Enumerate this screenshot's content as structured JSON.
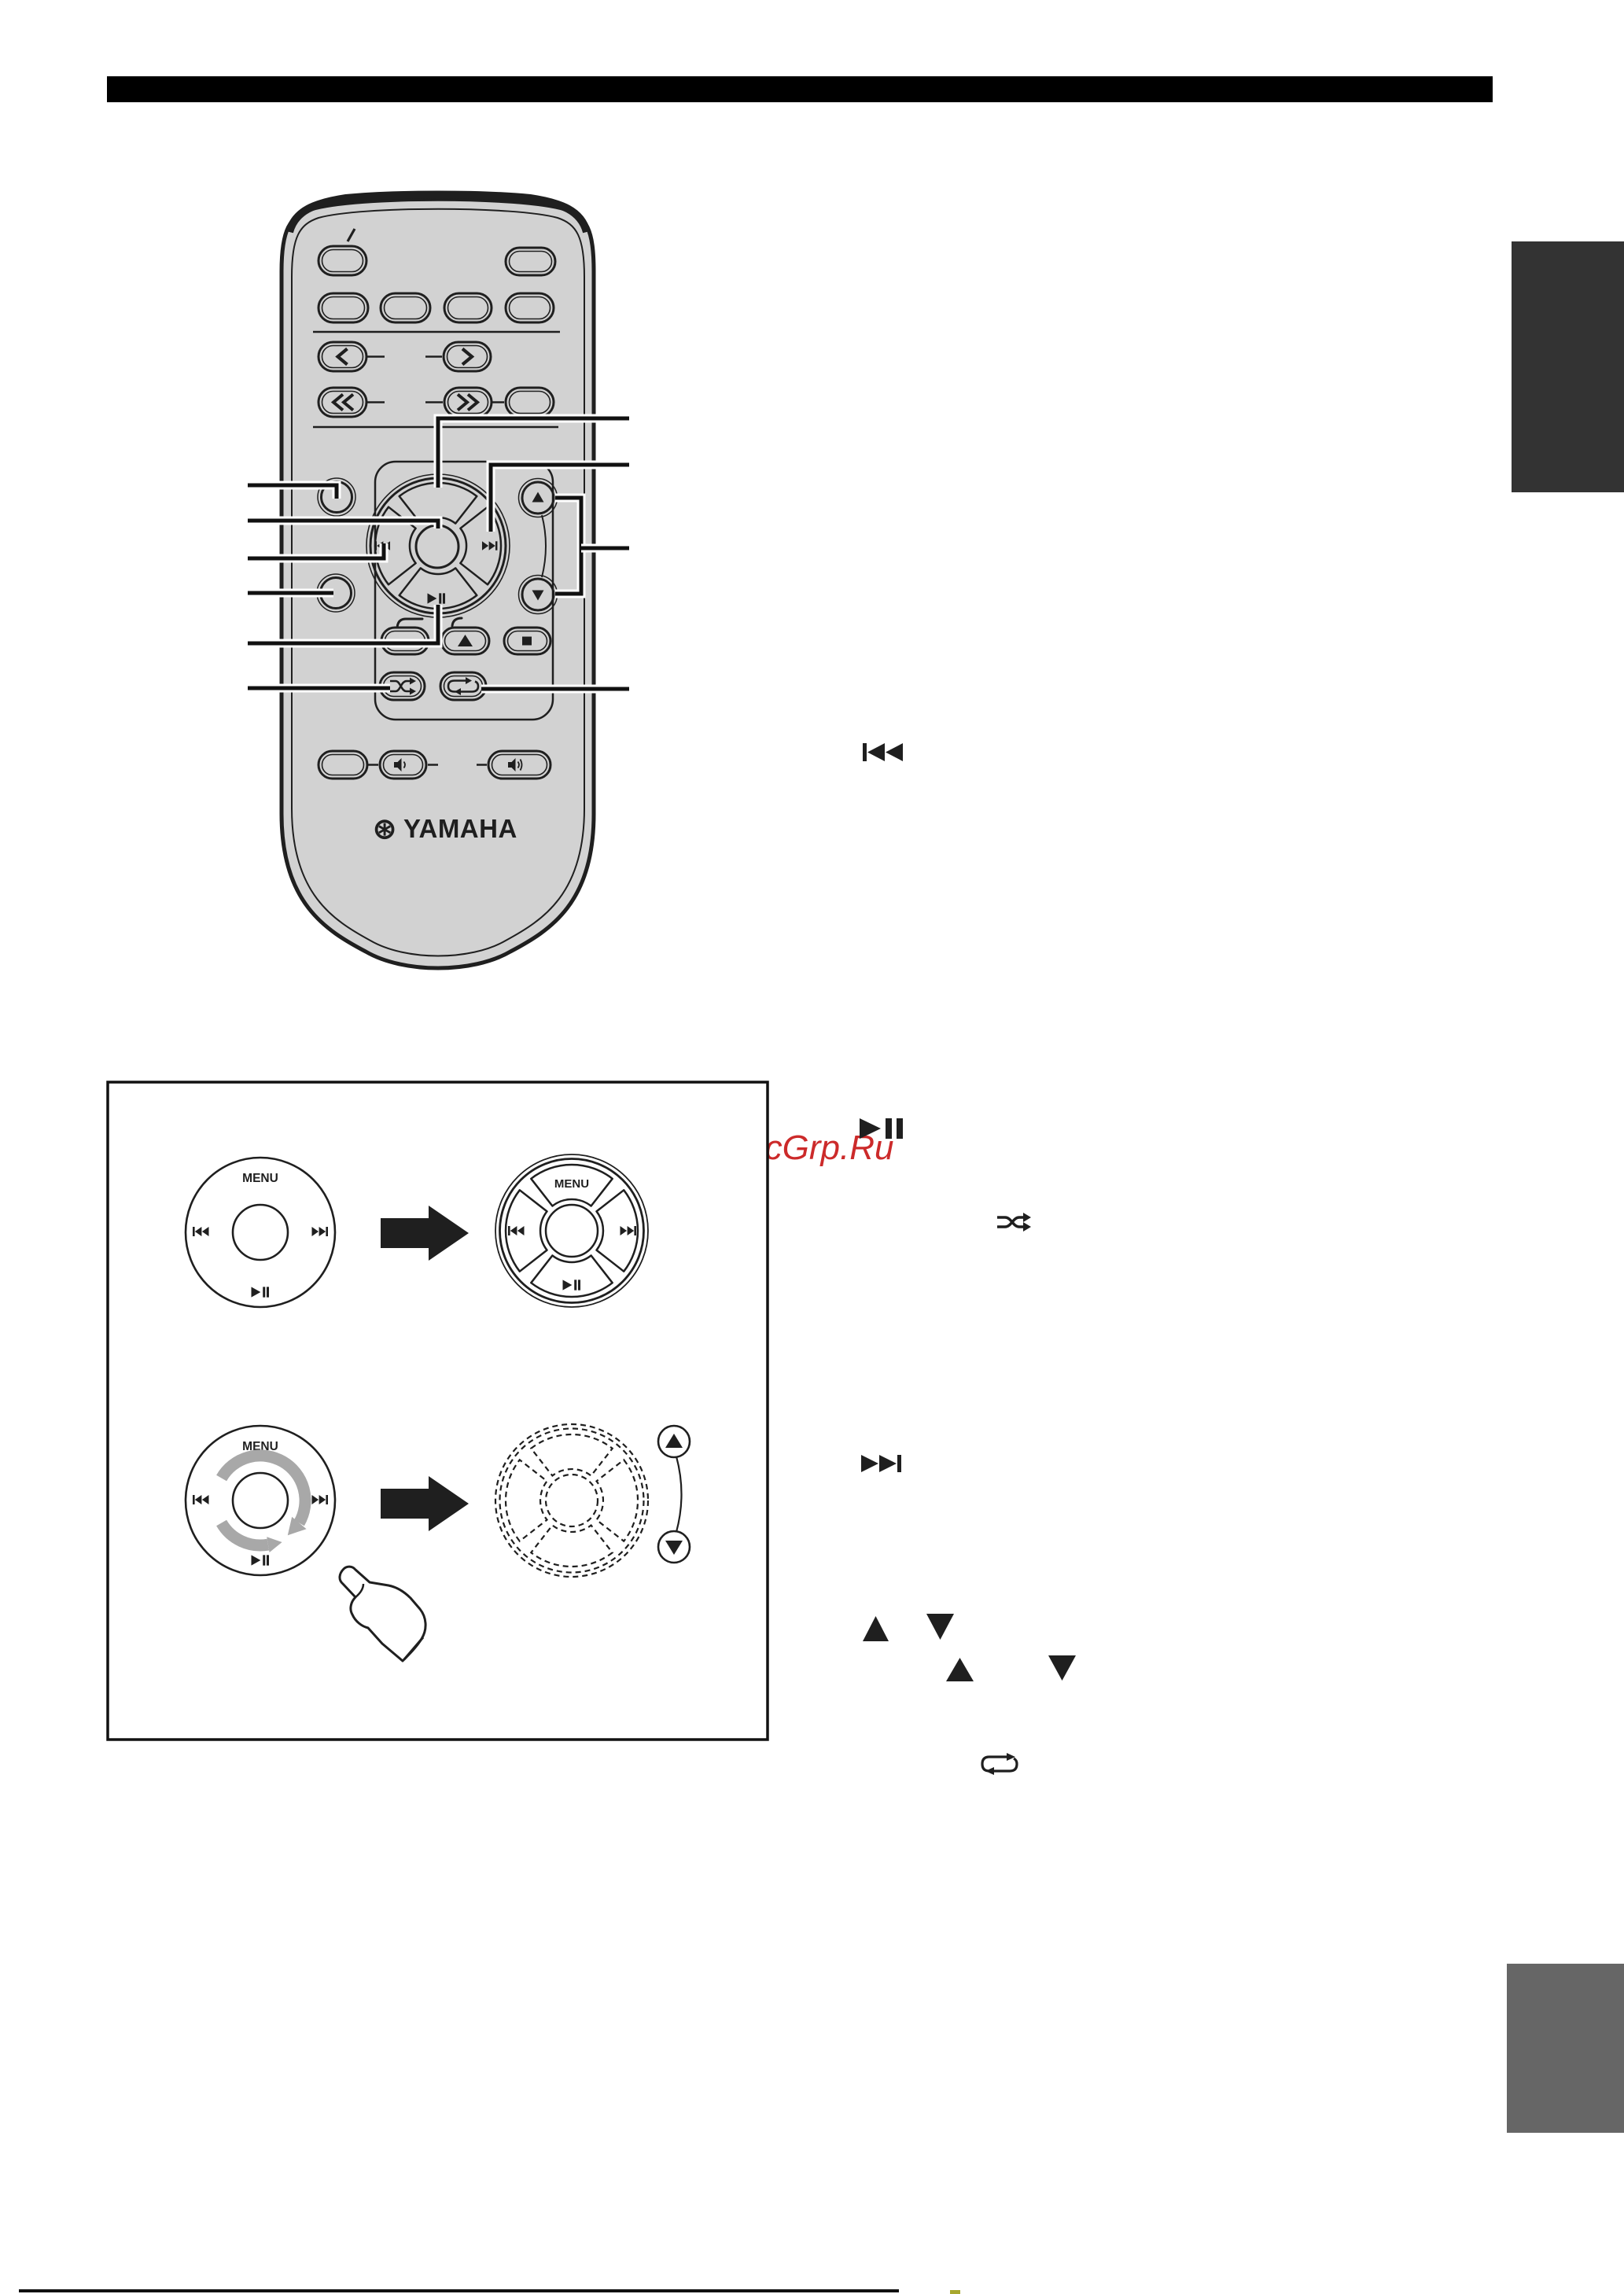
{
  "watermark": {
    "text": "McGrp.Ru",
    "color": "#cc2a2a"
  },
  "figure": {
    "menu_label": "MENU"
  },
  "remote": {
    "brand": "YAMAHA",
    "brand_mark": "⊛",
    "button_glyphs": [
      "power-slash",
      "back-chevron",
      "forward-chevron",
      "rewind-chevrons",
      "fastforward-chevrons",
      "previous-track",
      "next-track",
      "play-pause",
      "cursor-up",
      "cursor-down",
      "open-close",
      "eject",
      "stop",
      "shuffle",
      "repeat",
      "volume-down",
      "volume-up"
    ]
  },
  "inline_icons": [
    "previous-track",
    "play-pause",
    "shuffle",
    "next-track",
    "up-triangle",
    "down-triangle",
    "up-triangle",
    "down-triangle",
    "repeat"
  ],
  "colors": {
    "header_bar": "#000000",
    "side_tab_top": "#333333",
    "side_tab_bottom": "#666666",
    "watermark_red": "#cc2a2a",
    "remote_body": "#d2d2d2",
    "line_art": "#1f1f1f",
    "rotate_arrow_gray": "#a8a8a8",
    "footer_mark": "#a8a82e"
  }
}
